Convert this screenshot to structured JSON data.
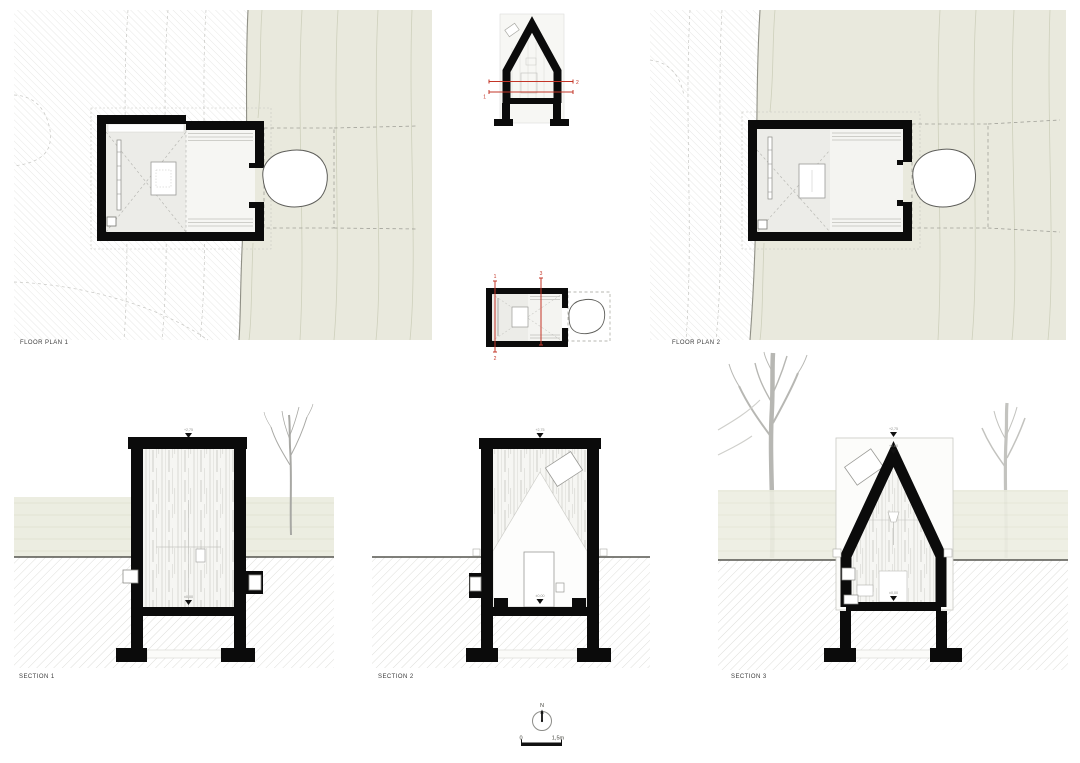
{
  "sheet_title": "cabin plans and sections drawing sheet",
  "plans": {
    "plan1_label": "FLOOR PLAN 1",
    "plan2_label": "FLOOR PLAN 2"
  },
  "sections": {
    "section1_label": "SECTION 1",
    "section2_label": "SECTION 2",
    "section3_label": "SECTION 3"
  },
  "cut_marks": {
    "plan_cut_upper": "2",
    "plan_cut_lower": "1",
    "section_cut_1": "1",
    "section_cut_2": "2",
    "section_cut_3": "3"
  },
  "levels": {
    "roof_top": "+2,75",
    "apex": "+2,60",
    "floor": "±0,00"
  },
  "north_indicator": {
    "label": "N"
  },
  "scale_bar": {
    "zero": "0",
    "max": "1,5m"
  },
  "colors": {
    "site_green": "#e9e9dd",
    "terrace_band": "#ecede1",
    "wall_black": "#0b0b0b",
    "cut_red": "#c33527",
    "tree_gray": "#b7b7b3",
    "rock_outline": "#5e5e5a"
  }
}
